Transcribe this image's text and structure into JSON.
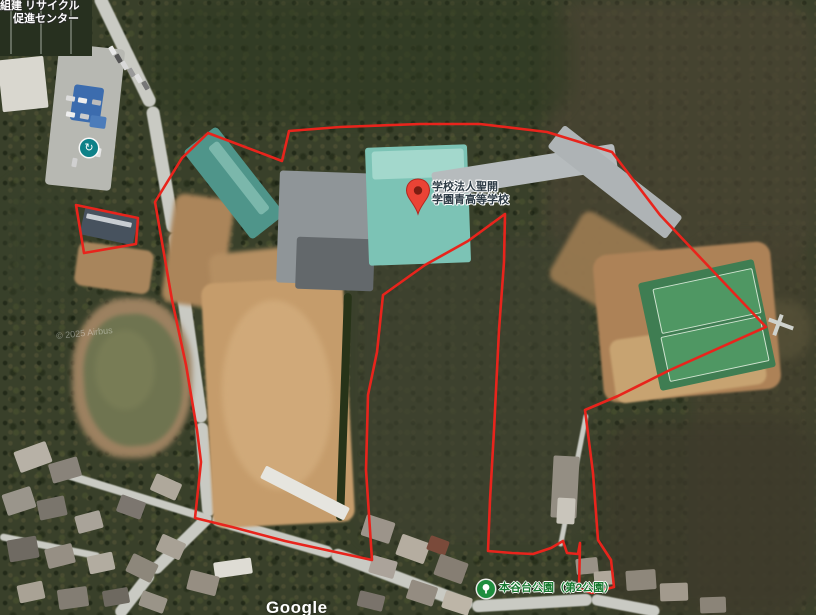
{
  "map": {
    "watermark": "Google",
    "imagery_credit": "© 2025 Airbus",
    "colors": {
      "boundary": "#e8241c",
      "pin_red": "#ea4335",
      "pin_dark": "#b3261e",
      "poi_teal": "#0e8188",
      "poi_park_green": "#1e8e3e",
      "park_text_green": "#17792f",
      "label_dark": "#2e3c46"
    },
    "pin_label": {
      "line1": "学校法人聖開",
      "line2": "学園青高等学校"
    },
    "recycle_label": {
      "line1": "組建 リサイクル",
      "line2": "促進センター"
    },
    "park_label": {
      "text": "本谷台公園（第2公園）"
    },
    "boundary_main": [
      [
        208,
        133
      ],
      [
        182,
        158
      ],
      [
        155,
        202
      ],
      [
        163,
        248
      ],
      [
        172,
        300
      ],
      [
        186,
        365
      ],
      [
        197,
        430
      ],
      [
        201,
        462
      ],
      [
        195,
        518
      ],
      [
        232,
        527
      ],
      [
        285,
        541
      ],
      [
        340,
        553
      ],
      [
        372,
        560
      ],
      [
        366,
        470
      ],
      [
        368,
        395
      ],
      [
        377,
        352
      ],
      [
        383,
        295
      ],
      [
        425,
        265
      ],
      [
        468,
        241
      ],
      [
        505,
        214
      ],
      [
        504,
        262
      ],
      [
        499,
        330
      ],
      [
        494,
        430
      ],
      [
        490,
        500
      ],
      [
        488,
        551
      ],
      [
        512,
        553
      ],
      [
        533,
        554
      ],
      [
        551,
        548
      ],
      [
        563,
        541
      ],
      [
        567,
        553
      ],
      [
        578,
        554
      ],
      [
        580,
        543
      ],
      [
        579,
        589
      ],
      [
        592,
        593
      ],
      [
        614,
        587
      ],
      [
        611,
        560
      ],
      [
        598,
        540
      ],
      [
        593,
        473
      ],
      [
        585,
        410
      ],
      [
        618,
        396
      ],
      [
        670,
        370
      ],
      [
        766,
        327
      ],
      [
        712,
        270
      ],
      [
        660,
        215
      ],
      [
        612,
        152
      ],
      [
        547,
        132
      ],
      [
        480,
        124
      ],
      [
        420,
        124
      ],
      [
        340,
        127
      ],
      [
        289,
        131
      ],
      [
        282,
        161
      ]
    ],
    "boundary_small": [
      [
        76,
        205
      ],
      [
        138,
        218
      ],
      [
        136,
        244
      ],
      [
        84,
        253
      ]
    ]
  },
  "scenery": {
    "patches": [
      {
        "x": 545,
        "y": 0,
        "w": 271,
        "h": 265,
        "rot": 0,
        "c": "#4a4433",
        "rad": "40px",
        "op": 0.75,
        "blur": 8
      },
      {
        "x": 690,
        "y": 240,
        "w": 126,
        "h": 380,
        "rot": 0,
        "c": "#46412f",
        "rad": "40px",
        "op": 0.7,
        "blur": 8
      },
      {
        "x": 355,
        "y": 235,
        "w": 240,
        "h": 310,
        "rot": 0,
        "c": "#3f4230",
        "rad": "40px",
        "op": 0.7,
        "blur": 8
      },
      {
        "x": 600,
        "y": 420,
        "w": 216,
        "h": 195,
        "rot": 0,
        "c": "#3d3a2b",
        "rad": "40px",
        "op": 0.75,
        "blur": 8
      },
      {
        "x": 150,
        "y": 0,
        "w": 420,
        "h": 120,
        "rot": 0,
        "c": "#2f3a22",
        "rad": "40px",
        "op": 0.6,
        "blur": 8
      },
      {
        "x": 0,
        "y": 180,
        "w": 80,
        "h": 130,
        "rot": 0,
        "c": "#37402a",
        "rad": "40px",
        "op": 0.6,
        "blur": 8
      },
      {
        "x": 750,
        "y": 300,
        "w": 62,
        "h": 60,
        "rot": 0,
        "c": "#565138",
        "rad": "30px",
        "op": 0.8,
        "blur": 5
      }
    ],
    "roads": [
      [
        98,
        -6,
        152,
        106,
        13
      ],
      [
        152,
        106,
        174,
        232,
        13
      ],
      [
        174,
        232,
        201,
        422,
        13
      ],
      [
        201,
        422,
        209,
        516,
        13
      ],
      [
        209,
        516,
        152,
        572,
        12
      ],
      [
        152,
        572,
        118,
        616,
        12
      ],
      [
        212,
        518,
        332,
        553,
        12
      ],
      [
        332,
        553,
        472,
        606,
        13
      ],
      [
        472,
        606,
        592,
        599,
        12
      ],
      [
        592,
        599,
        660,
        612,
        11
      ],
      [
        60,
        472,
        212,
        519,
        8
      ],
      [
        0,
        536,
        100,
        556,
        7
      ],
      [
        560,
        546,
        586,
        414,
        5
      ]
    ],
    "rects": [
      {
        "x": 52,
        "y": 46,
        "w": 66,
        "h": 142,
        "rot": 6,
        "c": "#b7b8b2",
        "rad": "4px"
      },
      {
        "x": 0,
        "y": 0,
        "w": 92,
        "h": 56,
        "rot": 0,
        "c": "#27301f",
        "rad": "0"
      },
      {
        "x": 10,
        "y": 0,
        "w": 2,
        "h": 54,
        "rot": 0,
        "c": "#8e9588",
        "op": 0.6
      },
      {
        "x": 40,
        "y": 0,
        "w": 2,
        "h": 54,
        "rot": 0,
        "c": "#8e9588",
        "op": 0.6
      },
      {
        "x": 70,
        "y": 0,
        "w": 2,
        "h": 54,
        "rot": 0,
        "c": "#8e9588",
        "op": 0.6
      },
      {
        "x": 0,
        "y": 58,
        "w": 46,
        "h": 52,
        "rot": -6,
        "c": "#d9d7cf",
        "rad": "2px"
      },
      {
        "x": 72,
        "y": 86,
        "w": 30,
        "h": 36,
        "rot": 8,
        "c": "#3c6cae",
        "rad": "3px"
      },
      {
        "x": 90,
        "y": 116,
        "w": 16,
        "h": 12,
        "rot": 8,
        "c": "#4c7cba",
        "rad": "2px"
      },
      {
        "x": 168,
        "y": 196,
        "w": 60,
        "h": 110,
        "rot": 8,
        "c": "#ab855a",
        "rad": "10px",
        "blur": 2
      },
      {
        "x": 210,
        "y": 248,
        "w": 130,
        "h": 45,
        "rot": -6,
        "c": "#b58f62",
        "rad": "10px",
        "blur": 2
      },
      {
        "x": 207,
        "y": 280,
        "w": 142,
        "h": 245,
        "rot": -3,
        "c": "#c59c6b",
        "rad": "12px",
        "blur": 1
      },
      {
        "x": 222,
        "y": 300,
        "w": 110,
        "h": 190,
        "rot": -3,
        "c": "#d2ac7c",
        "rad": "50%",
        "op": 0.85,
        "blur": 3
      },
      {
        "x": 560,
        "y": 225,
        "w": 90,
        "h": 80,
        "rot": 30,
        "c": "#9d7c52",
        "rad": "10px",
        "op": 0.9,
        "blur": 2
      },
      {
        "x": 598,
        "y": 248,
        "w": 178,
        "h": 148,
        "rot": -5,
        "c": "#ad8257",
        "rad": "14px",
        "blur": 1
      },
      {
        "x": 612,
        "y": 330,
        "w": 152,
        "h": 64,
        "rot": -8,
        "c": "#c7a371",
        "rad": "10px",
        "blur": 1
      },
      {
        "x": 76,
        "y": 246,
        "w": 76,
        "h": 44,
        "rot": 8,
        "c": "#a8855c",
        "rad": "8px",
        "blur": 1
      },
      {
        "x": 72,
        "y": 298,
        "w": 120,
        "h": 160,
        "rot": 0,
        "c": "#9c8160",
        "rad": "45%",
        "blur": 3
      },
      {
        "x": 84,
        "y": 314,
        "w": 98,
        "h": 132,
        "rot": -4,
        "c": "#6f7450",
        "rad": "45%",
        "blur": 2
      },
      {
        "x": 95,
        "y": 330,
        "w": 60,
        "h": 80,
        "rot": 0,
        "c": "#7d8058",
        "rad": "50%",
        "op": 0.7,
        "blur": 3
      },
      {
        "x": 340,
        "y": 293,
        "w": 8,
        "h": 228,
        "rot": 2,
        "c": "#273318",
        "rad": "4px"
      },
      {
        "x": 648,
        "y": 270,
        "w": 118,
        "h": 110,
        "rot": -12,
        "c": "#3f7d52",
        "rad": "3px"
      },
      {
        "x": 656,
        "y": 278,
        "w": 100,
        "h": 44,
        "rot": -12,
        "c": "#4f9763",
        "rad": "2px",
        "brd": "1px solid #cfe3cf"
      },
      {
        "x": 664,
        "y": 326,
        "w": 100,
        "h": 44,
        "rot": -12,
        "c": "#4f9763",
        "rad": "2px",
        "brd": "1px solid #cfe3cf"
      },
      {
        "x": 178,
        "y": 162,
        "w": 112,
        "h": 42,
        "rot": 52,
        "c": "#4f958a",
        "rad": "4px"
      },
      {
        "x": 196,
        "y": 172,
        "w": 86,
        "h": 12,
        "rot": 52,
        "c": "#7bb7ab",
        "rad": "3px"
      },
      {
        "x": 278,
        "y": 172,
        "w": 92,
        "h": 112,
        "rot": 2,
        "c": "#8f9598",
        "rad": "3px"
      },
      {
        "x": 296,
        "y": 238,
        "w": 78,
        "h": 52,
        "rot": 2,
        "c": "#63686b",
        "rad": "3px"
      },
      {
        "x": 367,
        "y": 146,
        "w": 102,
        "h": 118,
        "rot": -2,
        "c": "#7cc3b5",
        "rad": "3px"
      },
      {
        "x": 372,
        "y": 150,
        "w": 92,
        "h": 28,
        "rot": -2,
        "c": "#a3d8cc",
        "rad": "3px"
      },
      {
        "x": 432,
        "y": 158,
        "w": 185,
        "h": 26,
        "rot": -9,
        "c": "#b6bbbd",
        "rad": "3px"
      },
      {
        "x": 540,
        "y": 168,
        "w": 150,
        "h": 28,
        "rot": 38,
        "c": "#aeb3b5",
        "rad": "3px"
      },
      {
        "x": 82,
        "y": 212,
        "w": 54,
        "h": 28,
        "rot": 12,
        "c": "#47525e",
        "rad": "2px"
      },
      {
        "x": 86,
        "y": 218,
        "w": 46,
        "h": 5,
        "rot": 12,
        "c": "#c8cdd2",
        "rad": "1px"
      },
      {
        "x": 552,
        "y": 456,
        "w": 26,
        "h": 62,
        "rot": 3,
        "c": "#948e83",
        "rad": "2px"
      },
      {
        "x": 557,
        "y": 498,
        "w": 18,
        "h": 26,
        "rot": 3,
        "c": "#c9c5bb",
        "rad": "2px"
      },
      {
        "x": 258,
        "y": 486,
        "w": 94,
        "h": 14,
        "rot": 27,
        "c": "#e6e5df",
        "rad": "2px"
      },
      {
        "x": 214,
        "y": 560,
        "w": 38,
        "h": 16,
        "rot": -8,
        "c": "#dedcd4",
        "rad": "2px"
      },
      {
        "x": 768,
        "y": 322,
        "w": 26,
        "h": 4,
        "rot": 20,
        "c": "#cfd2cd"
      },
      {
        "x": 776,
        "y": 314,
        "w": 4,
        "h": 22,
        "rot": 20,
        "c": "#cfd2cd"
      },
      {
        "x": 16,
        "y": 446,
        "w": 34,
        "h": 22,
        "rot": -20,
        "c": "#b7b1a6",
        "rad": "2px"
      },
      {
        "x": 50,
        "y": 460,
        "w": 30,
        "h": 20,
        "rot": -16,
        "c": "#89837a",
        "rad": "2px"
      },
      {
        "x": 4,
        "y": 490,
        "w": 30,
        "h": 22,
        "rot": -18,
        "c": "#9a958b",
        "rad": "2px"
      },
      {
        "x": 38,
        "y": 498,
        "w": 28,
        "h": 20,
        "rot": -12,
        "c": "#7a756c",
        "rad": "2px"
      },
      {
        "x": 76,
        "y": 513,
        "w": 26,
        "h": 18,
        "rot": -15,
        "c": "#a9a399",
        "rad": "2px"
      },
      {
        "x": 8,
        "y": 538,
        "w": 30,
        "h": 22,
        "rot": -10,
        "c": "#6f6a62",
        "rad": "2px"
      },
      {
        "x": 46,
        "y": 546,
        "w": 28,
        "h": 20,
        "rot": -14,
        "c": "#968f84",
        "rad": "2px"
      },
      {
        "x": 88,
        "y": 554,
        "w": 26,
        "h": 18,
        "rot": -12,
        "c": "#b2aca0",
        "rad": "2px"
      },
      {
        "x": 128,
        "y": 558,
        "w": 28,
        "h": 20,
        "rot": 26,
        "c": "#8d877b",
        "rad": "2px"
      },
      {
        "x": 158,
        "y": 538,
        "w": 26,
        "h": 18,
        "rot": 24,
        "c": "#a8a195",
        "rad": "2px"
      },
      {
        "x": 118,
        "y": 498,
        "w": 26,
        "h": 18,
        "rot": 20,
        "c": "#7c766f",
        "rad": "2px"
      },
      {
        "x": 152,
        "y": 478,
        "w": 28,
        "h": 18,
        "rot": 24,
        "c": "#afa89b",
        "rad": "2px"
      },
      {
        "x": 188,
        "y": 573,
        "w": 30,
        "h": 20,
        "rot": 14,
        "c": "#968e82",
        "rad": "2px"
      },
      {
        "x": 58,
        "y": 588,
        "w": 30,
        "h": 20,
        "rot": -8,
        "c": "#837d73",
        "rad": "2px"
      },
      {
        "x": 18,
        "y": 583,
        "w": 26,
        "h": 18,
        "rot": -12,
        "c": "#a9a295",
        "rad": "2px"
      },
      {
        "x": 103,
        "y": 589,
        "w": 26,
        "h": 16,
        "rot": -10,
        "c": "#6e6960",
        "rad": "2px"
      },
      {
        "x": 140,
        "y": 594,
        "w": 26,
        "h": 16,
        "rot": 20,
        "c": "#9a9488",
        "rad": "2px"
      },
      {
        "x": 363,
        "y": 518,
        "w": 30,
        "h": 22,
        "rot": 18,
        "c": "#9c948a",
        "rad": "2px"
      },
      {
        "x": 398,
        "y": 538,
        "w": 30,
        "h": 22,
        "rot": 20,
        "c": "#b5ada0",
        "rad": "2px"
      },
      {
        "x": 428,
        "y": 538,
        "w": 20,
        "h": 15,
        "rot": 20,
        "c": "#7a4a3a",
        "rad": "2px"
      },
      {
        "x": 436,
        "y": 558,
        "w": 30,
        "h": 22,
        "rot": 20,
        "c": "#867e73",
        "rad": "2px"
      },
      {
        "x": 370,
        "y": 558,
        "w": 26,
        "h": 18,
        "rot": 16,
        "c": "#aba39a",
        "rad": "2px"
      },
      {
        "x": 408,
        "y": 583,
        "w": 28,
        "h": 20,
        "rot": 18,
        "c": "#948c81",
        "rad": "2px"
      },
      {
        "x": 443,
        "y": 594,
        "w": 28,
        "h": 18,
        "rot": 18,
        "c": "#bdb5a7",
        "rad": "2px"
      },
      {
        "x": 358,
        "y": 593,
        "w": 26,
        "h": 16,
        "rot": 14,
        "c": "#7a736b",
        "rad": "2px"
      },
      {
        "x": 576,
        "y": 558,
        "w": 22,
        "h": 16,
        "rot": -6,
        "c": "#999186",
        "rad": "2px"
      },
      {
        "x": 594,
        "y": 571,
        "w": 20,
        "h": 14,
        "rot": -4,
        "c": "#b0a89b",
        "rad": "2px"
      },
      {
        "x": 626,
        "y": 570,
        "w": 30,
        "h": 20,
        "rot": -4,
        "c": "#8e877b",
        "rad": "2px"
      },
      {
        "x": 660,
        "y": 583,
        "w": 28,
        "h": 18,
        "rot": -2,
        "c": "#a29a8d",
        "rad": "2px"
      },
      {
        "x": 700,
        "y": 597,
        "w": 26,
        "h": 16,
        "rot": -2,
        "c": "#8b8478",
        "rad": "2px"
      }
    ],
    "cars": [
      [
        108,
        48,
        60,
        "#e8e8e8"
      ],
      [
        114,
        56,
        60,
        "#555555"
      ],
      [
        120,
        63,
        60,
        "#d8d8d8"
      ],
      [
        127,
        70,
        60,
        "#999999"
      ],
      [
        134,
        76,
        60,
        "#e0e0e0"
      ],
      [
        141,
        83,
        60,
        "#777777"
      ],
      [
        66,
        96,
        10,
        "#dddddd"
      ],
      [
        78,
        98,
        10,
        "#eeeeee"
      ],
      [
        92,
        100,
        10,
        "#bbbbbb"
      ],
      [
        66,
        112,
        10,
        "#eeeeee"
      ],
      [
        80,
        114,
        10,
        "#cccccc"
      ],
      [
        94,
        150,
        100,
        "#e5e5e5"
      ],
      [
        70,
        160,
        100,
        "#d0d0d0"
      ]
    ]
  }
}
